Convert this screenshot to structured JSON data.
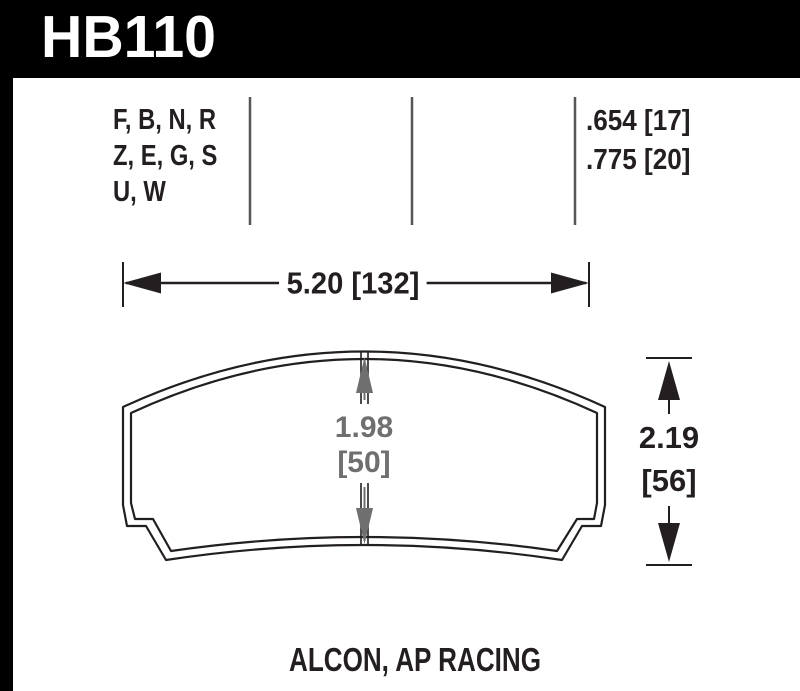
{
  "colors": {
    "header_bg": "#000000",
    "header_text": "#ffffff",
    "line_black": "#231f20",
    "divider_gray": "#565656",
    "dimension_gray": "#6f6f6f"
  },
  "header": {
    "part_number": "HB110"
  },
  "spec_table": {
    "compound_codes": [
      "F, B, N, R",
      "Z, E, G, S",
      "U, W"
    ],
    "pad_thickness": [
      ".654 [17]",
      ".775 [20]"
    ]
  },
  "dimensions": {
    "overall_width": "5.20 [132]",
    "inner_height": [
      "1.98",
      "[50]"
    ],
    "overall_height": [
      "2.19",
      "[56]"
    ]
  },
  "footer": {
    "applications": "ALCON, AP RACING"
  }
}
